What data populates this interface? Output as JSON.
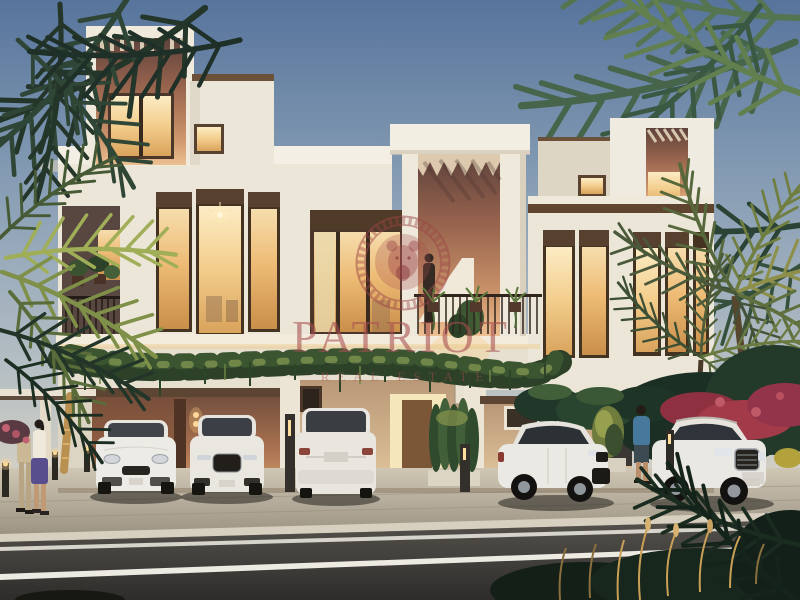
{
  "watermark": {
    "brand": "PATRIOT",
    "tagline": "REAL ESTATE",
    "emblem": "lion-medallion-with-greek-key-ring",
    "color": "#a84f4f"
  },
  "scene": {
    "setting": "twilight exterior rendering of a modern two-storey townhouse row",
    "time_of_day": "dusk",
    "elements": [
      "rooftop terraces with pergola slats and warm terracotta recesses",
      "floor-to-ceiling bronze-framed windows glowing warm",
      "balconies with dark railings and hanging plants",
      "cascading vines along the first-floor slab",
      "palm trees framing left and right edges",
      "red bougainvillea shrubs on the right",
      "paved driveway, curb and asphalt road with white lane lines"
    ],
    "vehicles": [
      "white SUV parked front-on (far left)",
      "white SUV parked front-on (left)",
      "white SUV parked rear-on (center)",
      "white compact SUV angled (right)",
      "white large SUV angled (far right)"
    ],
    "people": [
      "couple walking on the left sidewalk",
      "person standing on the central balcony",
      "man in blue shirt walking on the right"
    ]
  },
  "palette": {
    "sky_top": "#57749c",
    "sky_horizon": "#e6ddca",
    "wall_white": "#ece6d8",
    "wall_terracotta": "#9a654e",
    "window_glow": "#f3cd8c",
    "frame_bronze": "#443321",
    "foliage_dark": "#243629",
    "foliage_lit": "#9fae57",
    "bougainvillea": "#a23a4a",
    "road": "#3a3835",
    "pavement": "#bfb6a4",
    "watermark": "#a84f4f"
  }
}
